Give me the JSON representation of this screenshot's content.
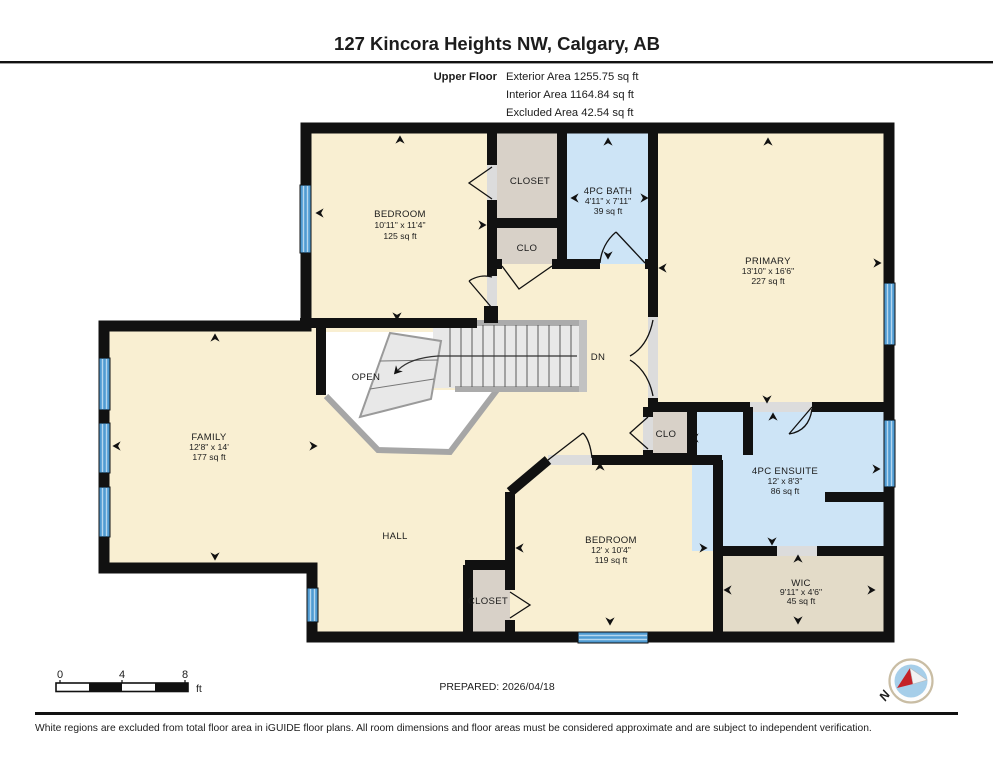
{
  "header": {
    "title": "127 Kincora Heights NW, Calgary, AB",
    "floor_label": "Upper Floor",
    "area_lines": [
      "Exterior Area 1255.75 sq ft",
      "Interior Area 1164.84 sq ft",
      "Excluded Area 42.54 sq ft"
    ]
  },
  "rooms": {
    "bedroom_top": {
      "name": "BEDROOM",
      "dims": "10'11\" x 11'4\"",
      "area": "125 sq ft"
    },
    "closet_top": {
      "name": "CLOSET"
    },
    "clo_top": {
      "name": "CLO"
    },
    "bath": {
      "name": "4PC BATH",
      "dims": "4'11\" x 7'11\"",
      "area": "39 sq ft"
    },
    "primary": {
      "name": "PRIMARY",
      "dims": "13'10\" x 16'6\"",
      "area": "227 sq ft"
    },
    "open": {
      "name": "OPEN"
    },
    "stairs": {
      "name": "DN"
    },
    "family": {
      "name": "FAMILY",
      "dims": "12'8\" x 14'",
      "area": "177 sq ft"
    },
    "hall": {
      "name": "HALL"
    },
    "clo_ensuite": {
      "name": "CLO"
    },
    "ensuite": {
      "name": "4PC ENSUITE",
      "dims": "12' x 8'3\"",
      "area": "86 sq ft"
    },
    "bedroom_bottom": {
      "name": "BEDROOM",
      "dims": "12' x 10'4\"",
      "area": "119 sq ft"
    },
    "closet_bottom": {
      "name": "CLOSET"
    },
    "wic": {
      "name": "WIC",
      "dims": "9'11\" x 4'6\"",
      "area": "45 sq ft"
    }
  },
  "footer": {
    "scale": {
      "tick_0": "0",
      "tick_4": "4",
      "tick_8": "8",
      "unit": "ft"
    },
    "prepared": "PREPARED: 2026/04/18",
    "compass_north": "N",
    "disclaimer": "White regions are excluded from total floor area in iGUIDE floor plans. All room dimensions and floor areas must be considered approximate and are subject to independent verification."
  },
  "palette": {
    "wall": "#111111",
    "floor_cream": "#f9efd2",
    "wet_room_blue": "#cde4f6",
    "closet_gray": "#d8d1c8",
    "wic_tan": "#e3dbc8",
    "stair_gray": "#e8e8e8",
    "window_blue": "#4f9bd2"
  }
}
